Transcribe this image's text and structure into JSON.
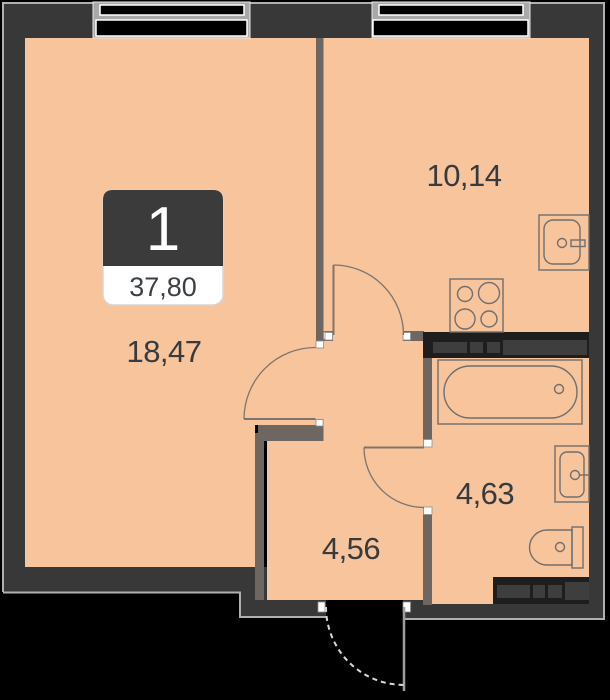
{
  "plan": {
    "type": "apartment-floor-plan",
    "badge": {
      "rooms_count": "1",
      "total_area": "37,80"
    },
    "rooms": {
      "living_room": {
        "area": "18,47"
      },
      "kitchen": {
        "area": "10,14"
      },
      "bathroom": {
        "area": "4,63"
      },
      "hallway": {
        "area": "4,56"
      }
    },
    "fixtures": [
      "window",
      "window",
      "kitchen-sink",
      "stove",
      "bathtub",
      "washbasin",
      "toilet",
      "ventilation-shaft",
      "ventilation-shaft",
      "entrance-door",
      "interior-doors"
    ],
    "colors": {
      "floor": "#f7c49c",
      "outer_wall": "#383838",
      "inner_wall": "#6e6660",
      "shaft_bg": "#1e1e1e",
      "shaft_block": "#3e3e3e",
      "wall_outline": "#b0b0b0",
      "label_text": "#363b40",
      "badge_bg": "#3b3b3b",
      "badge_text": "#ffffff",
      "outside": "#000000"
    }
  }
}
